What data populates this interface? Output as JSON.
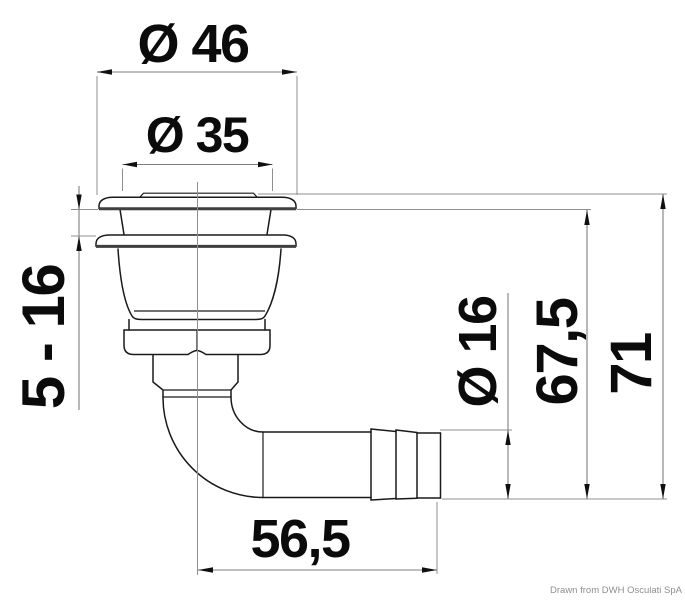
{
  "drawing": {
    "labels": {
      "flange_diameter": "Ø 46",
      "cap_diameter": "Ø 35",
      "panel_range": "5 - 16",
      "hose_barb_diameter": "Ø 16",
      "height_under_flange": "67,5",
      "overall_height": "71",
      "elbow_length": "56,5"
    },
    "credit": "Drawn from DWH Osculati SpA"
  },
  "colors": {
    "outline": "#1a1a1a",
    "flange_sole": "#3f3f3f",
    "dimension_line": "#7d7d7d",
    "extension_line": "#8f8f8f",
    "text": "#0b0b0b",
    "credit": "#8f8f8f",
    "background": "#ffffff"
  }
}
